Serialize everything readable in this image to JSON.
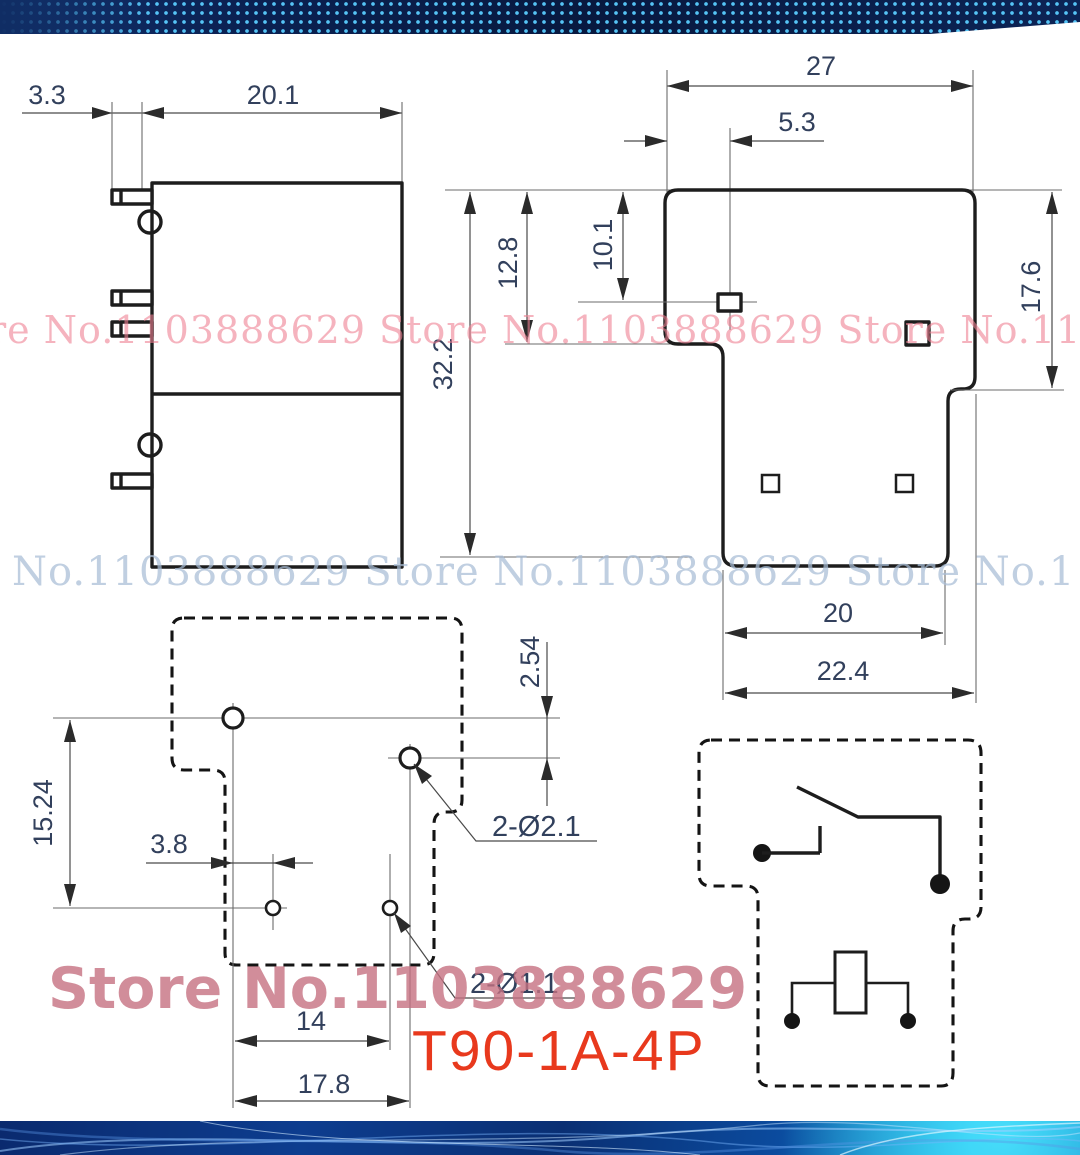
{
  "title": {
    "model": "T90-1A-4P"
  },
  "watermarks": {
    "row1": "re No.1103888629  Store No.1103888629  Store No.110388862",
    "row2": "No.1103888629  Store No.1103888629  Store No.1103888",
    "big": "Store No.1103888629"
  },
  "views": {
    "side_view": {
      "dims": {
        "pin_length": "3.3",
        "body_width": "20.1",
        "body_height": "32.2"
      }
    },
    "front_view": {
      "dims": {
        "width": "27",
        "pin_offset": "5.3",
        "upper_height": "12.8",
        "pin_inset": "10.1",
        "right_height": "17.6",
        "base_width": "20",
        "base_full_width": "22.4"
      }
    },
    "footprint": {
      "dims": {
        "row_pitch": "15.24",
        "col_offset": "3.8",
        "grid_pitch": "2.54",
        "span_inner": "14",
        "span_outer": "17.8"
      },
      "hole_labels": {
        "large": "2-Ø2.1",
        "small": "2-Ø1.1"
      }
    }
  },
  "colors": {
    "accent_red": "#e8391d",
    "watermark_pink": "#ef8092",
    "watermark_blue": "#a7bcd5",
    "watermark_rose": "#c67181",
    "dim_text": "#32405c",
    "line_dark": "#1d1d1d",
    "band_navy": "#0b2152",
    "band_dot_blue": "#5acdff",
    "footer_cyan": "#18b5e7"
  }
}
